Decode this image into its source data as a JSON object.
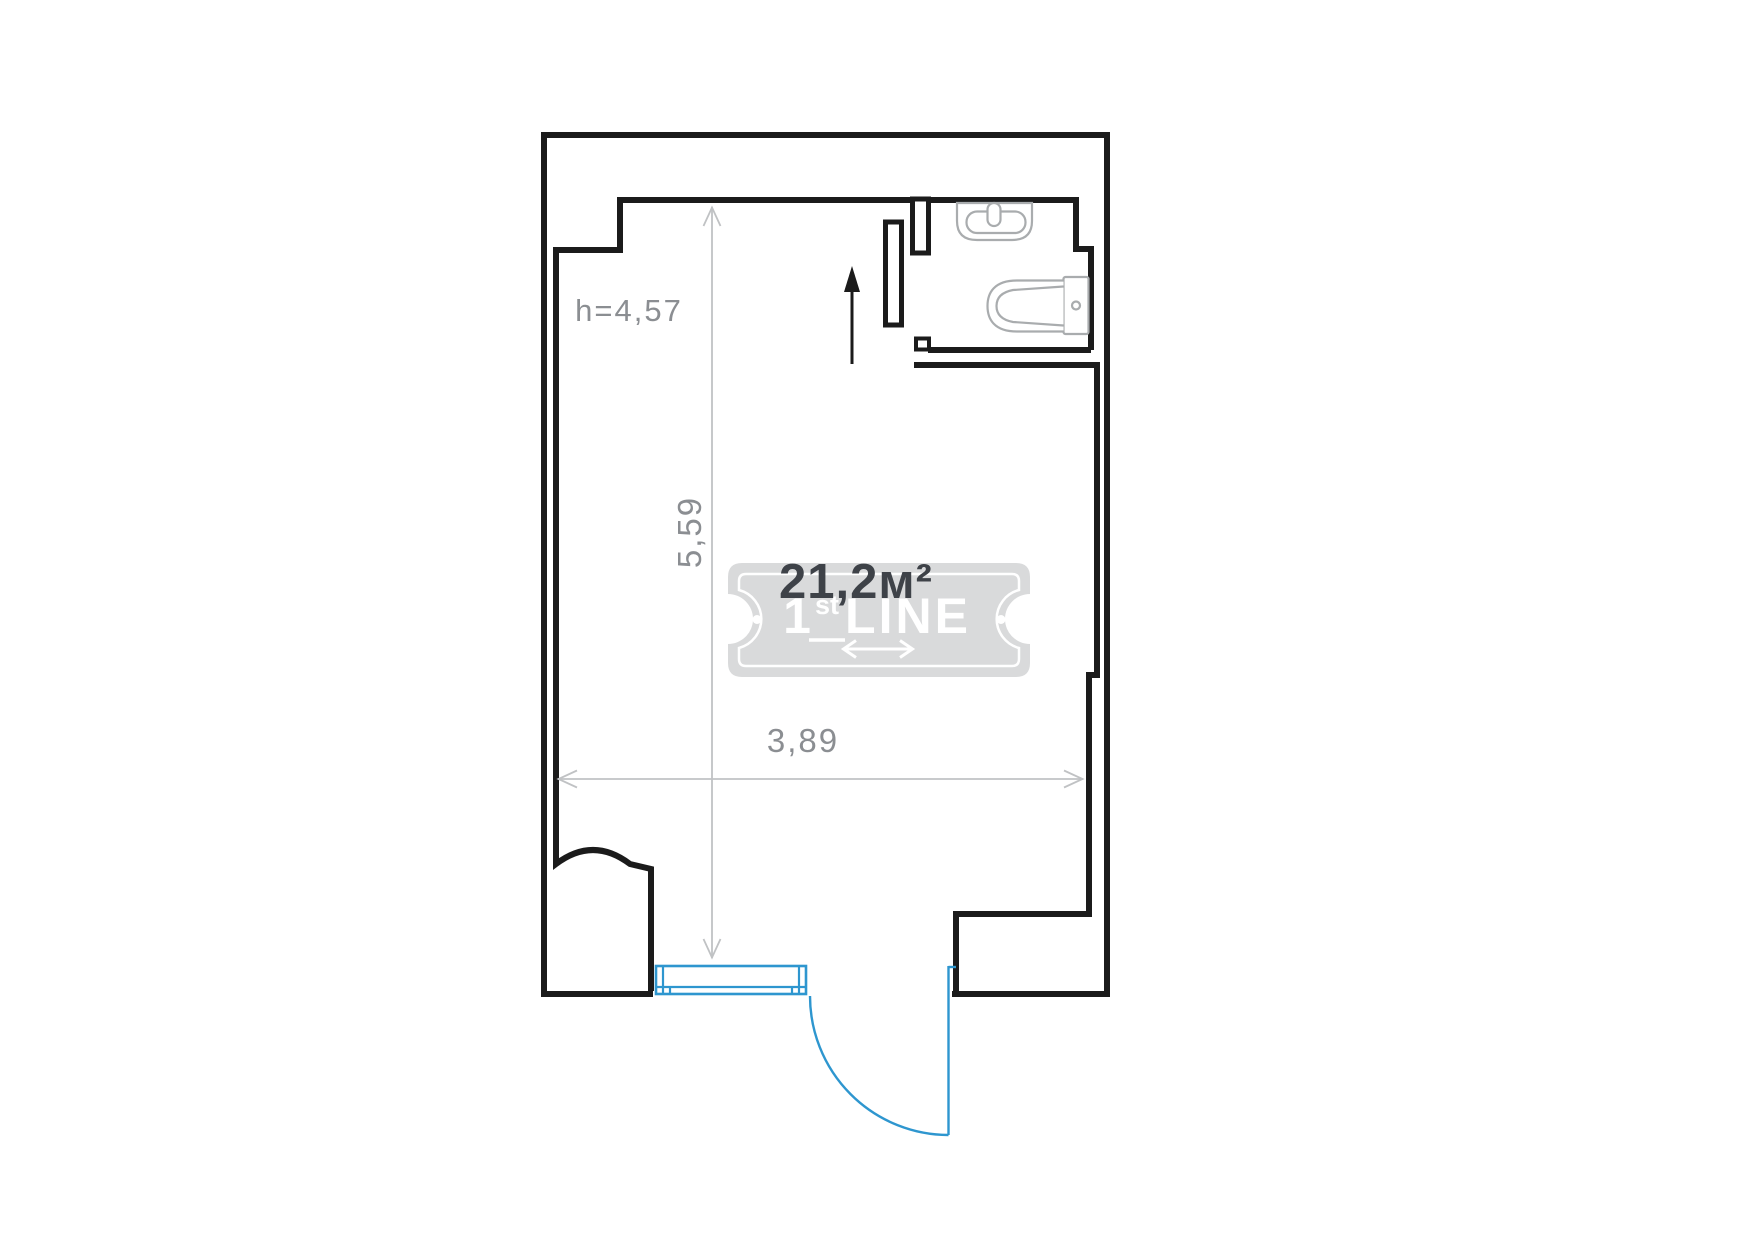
{
  "floorplan": {
    "area_label": "21,2м²",
    "ceiling_height_label": "h=4,57",
    "dimensions": {
      "vertical": "5,59",
      "horizontal": "3,89"
    },
    "watermark": {
      "prefix": "1",
      "superscript": "st",
      "word": "LINE"
    },
    "icons": {
      "sink": "sink-icon",
      "toilet": "toilet-icon",
      "entry_arrow": "entry-arrow-icon",
      "window": "window-icon",
      "door_swing": "door-swing-icon",
      "watermark_arrow": "double-arrow-icon"
    },
    "colors": {
      "wall": "#1b1b1b",
      "fixture": "#a9acae",
      "dimension_line": "#c0c2c4",
      "dimension_text": "#8b8e92",
      "area_text": "#3e4248",
      "watermark_fill": "#d9dadb",
      "watermark_ink": "#ffffff",
      "window_door": "#2e96cf"
    }
  }
}
